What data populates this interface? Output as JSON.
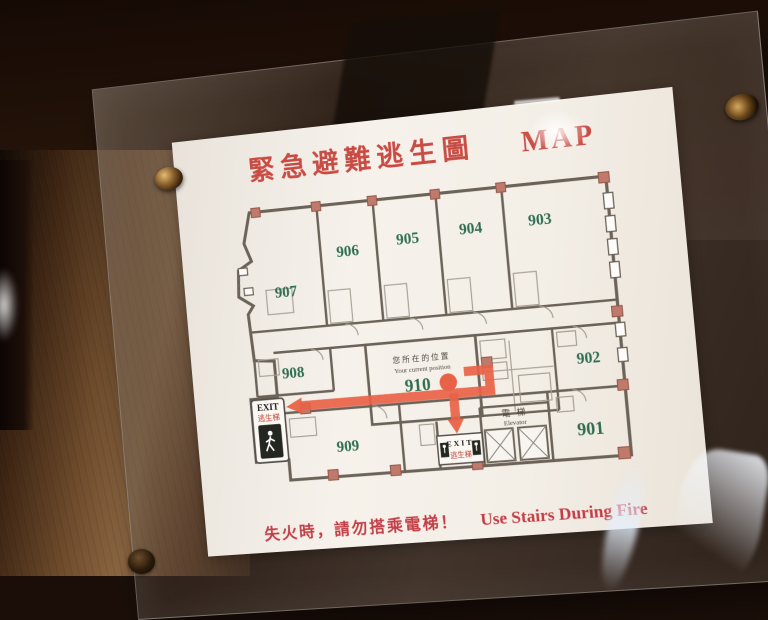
{
  "sign": {
    "title": {
      "zh": "緊急避難逃生圖",
      "en": "MAP"
    },
    "footer": {
      "zh": "失火時，請勿搭乘電梯！",
      "en": "Use Stairs During Fire"
    }
  },
  "floor_plan": {
    "current_position": {
      "room": "910",
      "label_zh": "您所在的位置",
      "label_en": "Your current position"
    },
    "rooms": [
      {
        "number": "907"
      },
      {
        "number": "906"
      },
      {
        "number": "905"
      },
      {
        "number": "904"
      },
      {
        "number": "903"
      },
      {
        "number": "908"
      },
      {
        "number": "902"
      },
      {
        "number": "909"
      },
      {
        "number": "901"
      }
    ],
    "exit_left": {
      "en": "EXIT",
      "zh": "逃生梯"
    },
    "exit_bottom": {
      "en": "EXIT",
      "zh": "逃生梯"
    },
    "elevator": {
      "zh": "電 梯",
      "en": "Elevator"
    }
  },
  "colors": {
    "title_red": "#c94c44",
    "footer_red": "#c43d46",
    "route_red": "#e86247",
    "room_green": "#2f6e52",
    "wall": "#6b6258",
    "column_fill": "#c07a6b"
  }
}
